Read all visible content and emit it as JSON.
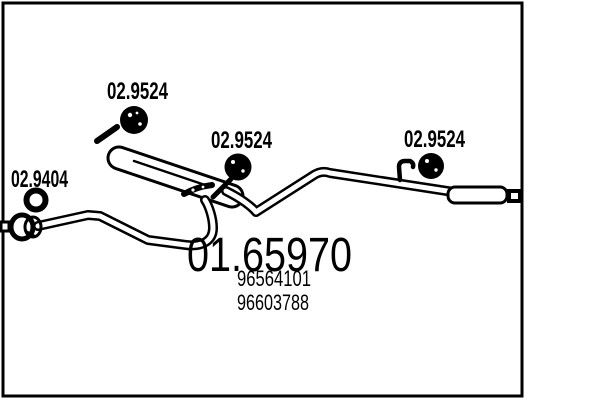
{
  "diagram": {
    "kind": "exhaust-system-part-drawing",
    "background_color": "#ffffff",
    "line_color": "#000000"
  },
  "part_labels": {
    "gasket": "02.9404",
    "hanger_front": "02.9524",
    "hanger_middle": "02.9524",
    "hanger_rear": "02.9524"
  },
  "part_numbers": {
    "main": "01.65970",
    "oe_1": "96564101",
    "oe_2": "96603788"
  }
}
